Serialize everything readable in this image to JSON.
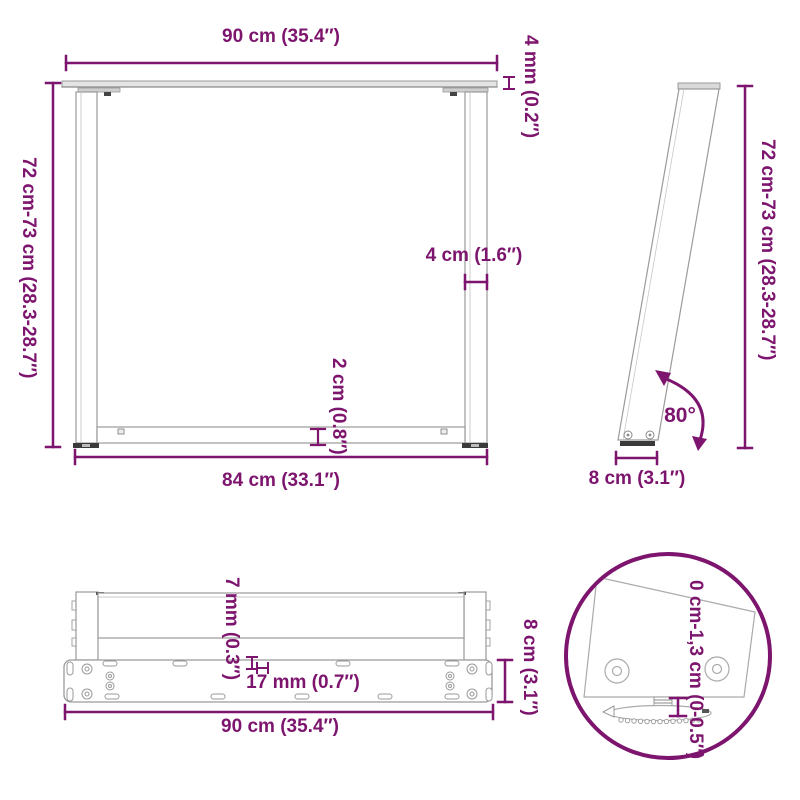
{
  "diagram_title": "table-leg-dimension-diagram",
  "accent_color": "#7D156E",
  "drawing_line_color": "#9A9A9A",
  "views": {
    "front": {
      "width_top": "90 cm (35.4″)",
      "top_thickness": "4 mm (0.2″)",
      "height_range": "72 cm-73 cm (28.3-28.7″)",
      "leg_width": "4 cm (1.6″)",
      "crossbar_height": "2 cm (0.8″)",
      "width_bottom": "84 cm (33.1″)"
    },
    "side": {
      "height_range": "72 cm-73 cm (28.3-28.7″)",
      "angle": "80°",
      "foot_depth": "8 cm (3.1″)"
    },
    "plan": {
      "hole_diameter": "7 mm (0.3″)",
      "slot_length": "17 mm (0.7″)",
      "plate_depth": "8 cm (3.1″)",
      "width": "90 cm (35.4″)"
    },
    "detail": {
      "adjust_range": "0 cm-1,3 cm (0-0.5″)"
    }
  }
}
